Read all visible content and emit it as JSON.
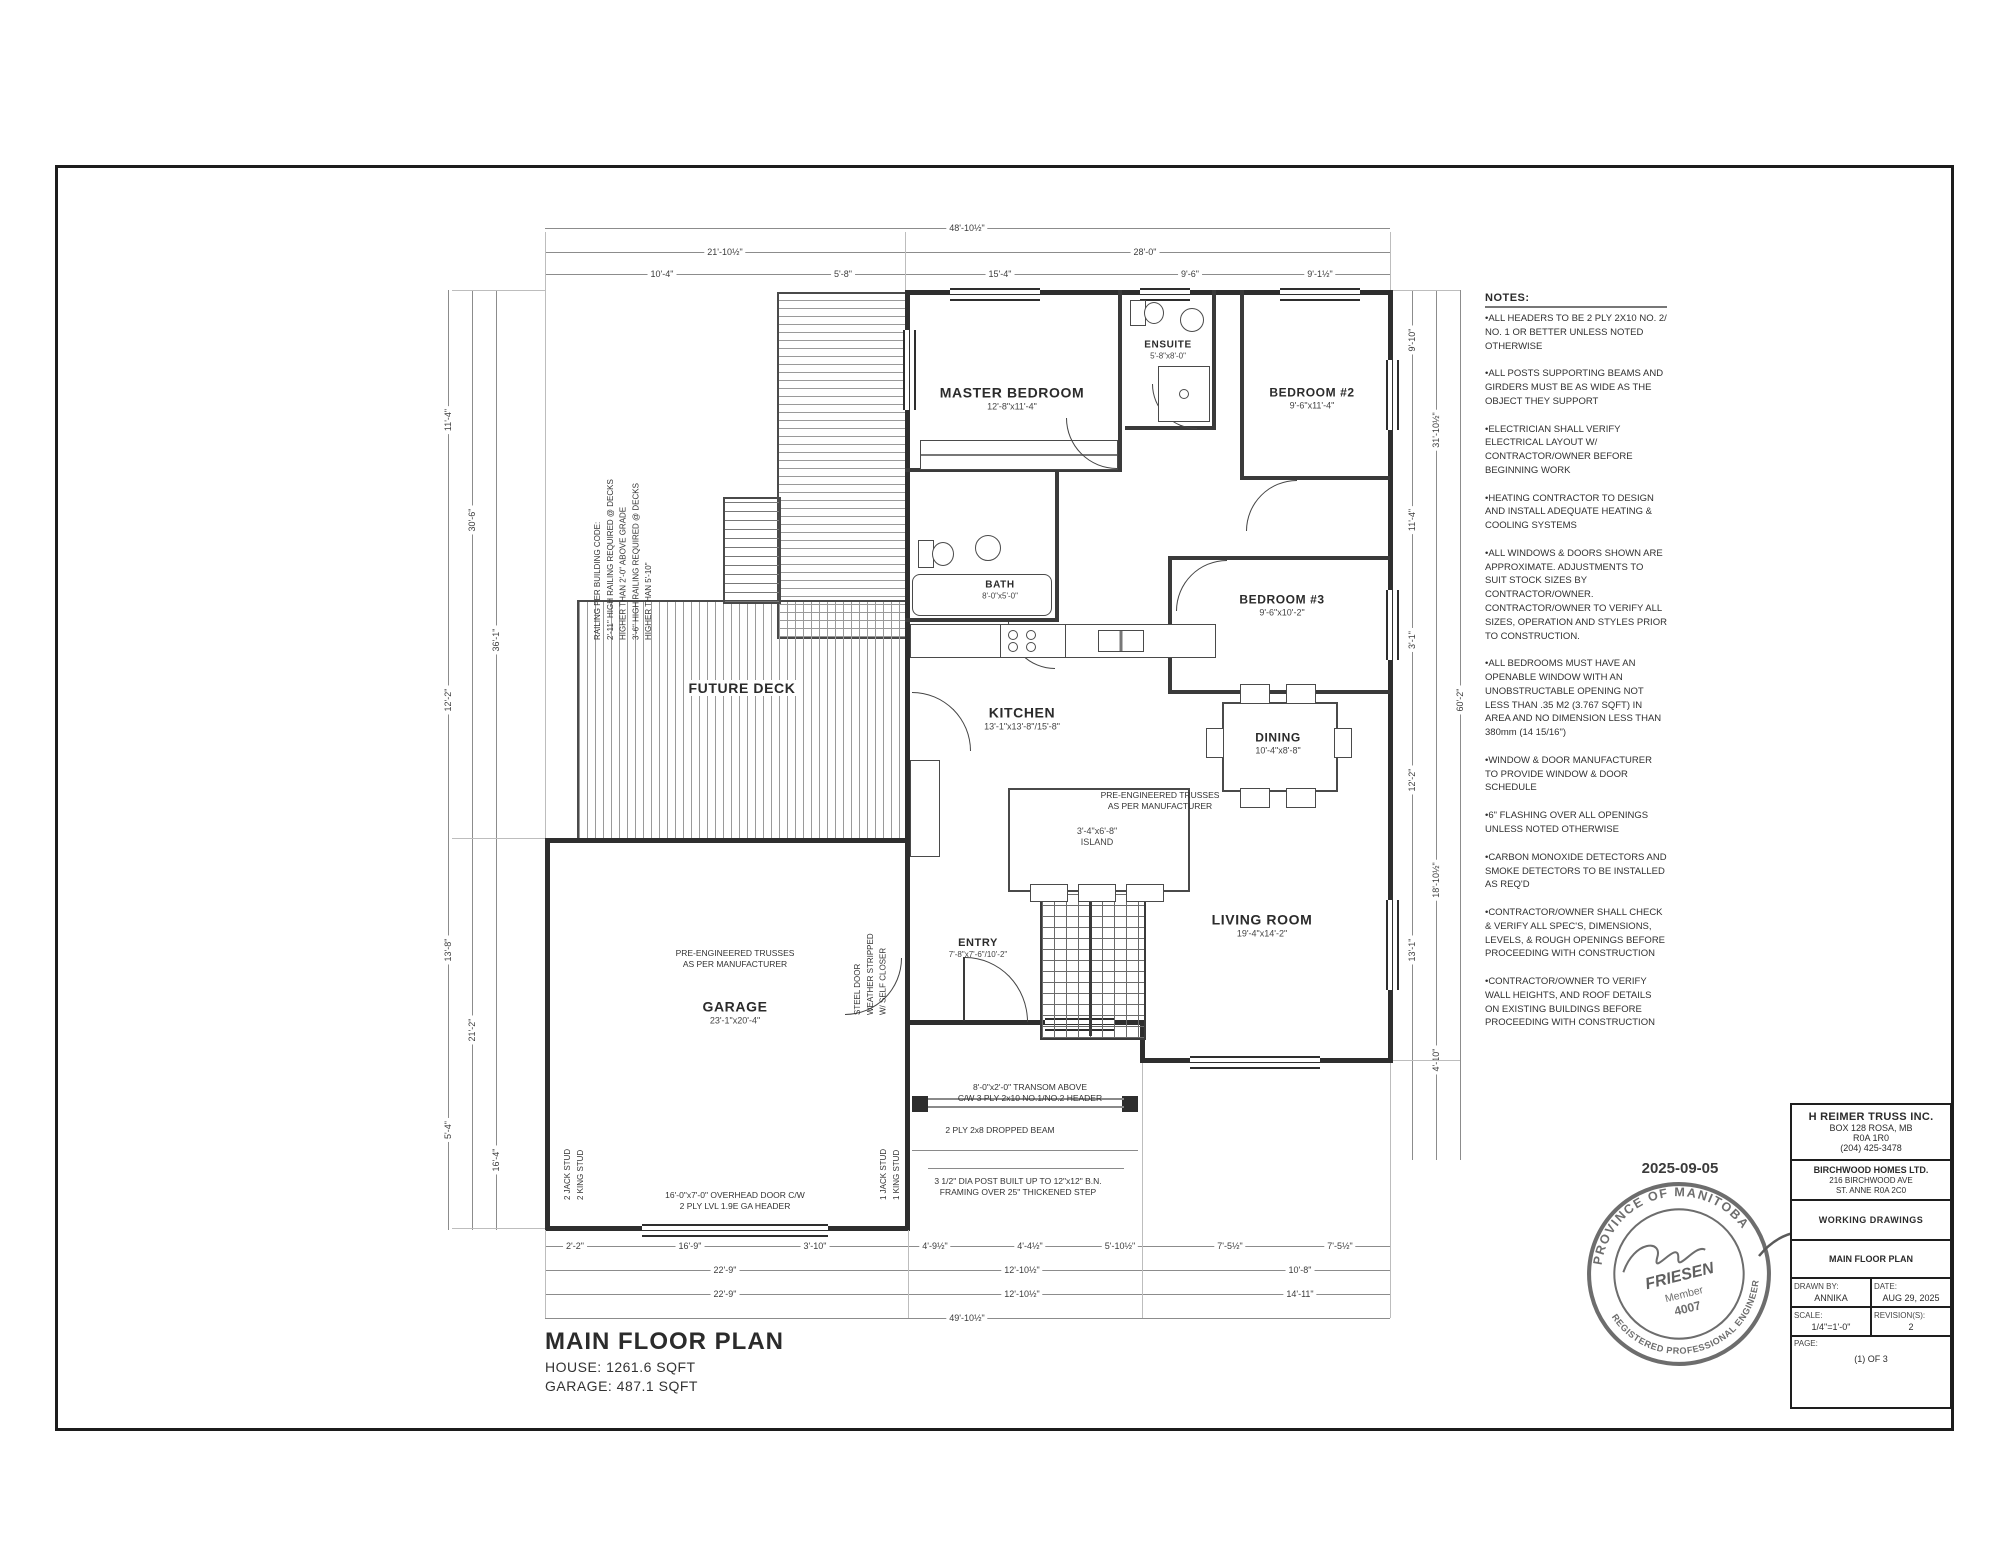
{
  "sheet": {
    "plan_title": "MAIN FLOOR PLAN",
    "house_area": "HOUSE: 1261.6 SQFT",
    "garage_area": "GARAGE: 487.1 SQFT"
  },
  "rooms": {
    "master_bedroom": {
      "name": "MASTER BEDROOM",
      "size": "12'-8\"x11'-4\""
    },
    "ensuite": {
      "name": "ENSUITE",
      "size": "5'-8\"x8'-0\""
    },
    "bedroom2": {
      "name": "BEDROOM #2",
      "size": "9'-6\"x11'-4\""
    },
    "bedroom3": {
      "name": "BEDROOM #3",
      "size": "9'-6\"x10'-2\""
    },
    "bath": {
      "name": "BATH",
      "size": "8'-0\"x5'-0\""
    },
    "kitchen": {
      "name": "KITCHEN",
      "size": "13'-1\"x13'-8\"/15'-8\""
    },
    "island": {
      "name": "ISLAND",
      "size": "3'-4\"x6'-8\""
    },
    "dining": {
      "name": "DINING",
      "size": "10'-4\"x8'-8\""
    },
    "living_room": {
      "name": "LIVING ROOM",
      "size": "19'-4\"x14'-2\""
    },
    "entry": {
      "name": "ENTRY",
      "size": "7'-8\"x7'-6\"/10'-2\""
    },
    "garage": {
      "name": "GARAGE",
      "size": "23'-1\"x20'-4\""
    },
    "future_deck": {
      "name": "FUTURE DECK"
    }
  },
  "annotations": {
    "railing": "RAILING PER BUILDING CODE:\n2'-11\" HIGH RAILING REQUIRED @ DECKS\nHIGHER THAN 2'-0\" ABOVE GRADE\n3'-6\" HIGH RAILING REQUIRED @ DECKS\nHIGHER THAN 5'-10\"",
    "trusses_house": "PRE-ENGINEERED TRUSSES\nAS PER MANUFACTURER",
    "trusses_garage": "PRE-ENGINEERED TRUSSES\nAS PER MANUFACTURER",
    "steel_door": "STEEL DOOR\nWEATHER STRIPPED\nW/ SELF CLOSER",
    "transom": "8'-0\"x2'-0\" TRANSOM ABOVE\nC/W 3 PLY 2x10 NO.1/NO.2 HEADER",
    "dropped_beam": "2 PLY 2x8 DROPPED BEAM",
    "post": "3 1/2\" DIA POST BUILT UP TO 12\"x12\" B.N.\nFRAMING OVER 25\" THICKENED STEP",
    "overhead_door": "16'-0\"x7'-0\" OVERHEAD DOOR C/W\n2 PLY LVL 1.9E GA HEADER",
    "stud_left": "2 JACK STUD\n2 KING STUD",
    "stud_right": "1 JACK STUD\n1 KING STUD"
  },
  "notes_panel": {
    "title": "NOTES:",
    "items": [
      "•ALL HEADERS TO BE 2 PLY 2X10 NO. 2/ NO. 1 OR BETTER UNLESS NOTED OTHERWISE",
      "•ALL POSTS SUPPORTING BEAMS AND GIRDERS MUST BE AS WIDE AS THE OBJECT THEY SUPPORT",
      "•ELECTRICIAN SHALL VERIFY ELECTRICAL LAYOUT W/ CONTRACTOR/OWNER BEFORE BEGINNING WORK",
      "•HEATING CONTRACTOR TO DESIGN AND INSTALL ADEQUATE HEATING & COOLING SYSTEMS",
      "•ALL WINDOWS & DOORS SHOWN ARE APPROXIMATE. ADJUSTMENTS TO SUIT STOCK SIZES BY CONTRACTOR/OWNER. CONTRACTOR/OWNER TO VERIFY ALL SIZES, OPERATION AND STYLES PRIOR TO CONSTRUCTION.",
      "•ALL BEDROOMS MUST HAVE AN OPENABLE WINDOW WITH AN UNOBSTRUCTABLE OPENING NOT LESS THAN .35 M2 (3.767 SQFT) IN AREA AND NO DIMENSION LESS THAN 380mm (14 15/16\")",
      "•WINDOW & DOOR MANUFACTURER TO PROVIDE WINDOW & DOOR SCHEDULE",
      "•6\" FLASHING OVER ALL OPENINGS UNLESS NOTED OTHERWISE",
      "•CARBON MONOXIDE DETECTORS AND SMOKE DETECTORS TO BE INSTALLED AS REQ'D",
      "•CONTRACTOR/OWNER SHALL CHECK & VERIFY ALL SPEC'S, DIMENSIONS, LEVELS, & ROUGH OPENINGS BEFORE PROCEEDING WITH CONSTRUCTION",
      "•CONTRACTOR/OWNER TO VERIFY WALL HEIGHTS, AND ROOF DETAILS ON EXISTING BUILDINGS BEFORE PROCEEDING WITH CONSTRUCTION"
    ]
  },
  "title_block": {
    "company": {
      "name": "H REIMER TRUSS INC.",
      "addr1": "BOX 128 ROSA, MB",
      "addr2": "R0A 1R0",
      "phone": "(204) 425-3478"
    },
    "client": {
      "name": "BIRCHWOOD HOMES LTD.",
      "addr1": "216 BIRCHWOOD AVE",
      "addr2": "ST. ANNE",
      "addr3": "R0A 2C0"
    },
    "doc_type": "WORKING DRAWINGS",
    "sheet_name": "MAIN FLOOR PLAN",
    "drawn_by_label": "DRAWN BY:",
    "drawn_by": "ANNIKA",
    "date_label": "DATE:",
    "date": "AUG 29, 2025",
    "scale_label": "SCALE:",
    "scale": "1/4\"=1'-0\"",
    "revisions_label": "REVISION(S):",
    "revisions": "2",
    "page_label": "PAGE:",
    "page": "(1) OF 3"
  },
  "stamp": {
    "date": "2025-09-05",
    "arc_top": "PROVINCE OF MANITOBA",
    "arc_bottom": "REGISTERED PROFESSIONAL ENGINEER",
    "name": "FRIESEN",
    "member_label": "Member",
    "member_number": "4007"
  },
  "dims": {
    "top": [
      "48'-10½\"",
      "21'-10½\"",
      "28'-0\"",
      "10'-4\"",
      "5'-8\"",
      "15'-4\"",
      "9'-6\"",
      "9'-1½\""
    ],
    "bottom": [
      "2'-2\"",
      "16'-9\"",
      "3'-10\"",
      "4'-9½\"",
      "4'-4½\"",
      "5'-10½\"",
      "7'-5½\"",
      "7'-5½\"",
      "22'-9\"",
      "12'-10½\"",
      "10'-8\"",
      "22'-9\"",
      "12'-10½\"",
      "14'-11\"",
      "49'-10½\""
    ],
    "left": [
      "11'-4\"",
      "12'-2\"",
      "13'-8\"",
      "5'-4\"",
      "30'-6\"",
      "21'-2\"",
      "36'-1\"",
      "16'-4\""
    ],
    "right": [
      "9'-10\"",
      "11'-4\"",
      "3'-1\"",
      "12'-2\"",
      "13'-1\"",
      "31'-10½\"",
      "18'-10½\"",
      "4'-10\"",
      "60'-2\""
    ]
  }
}
